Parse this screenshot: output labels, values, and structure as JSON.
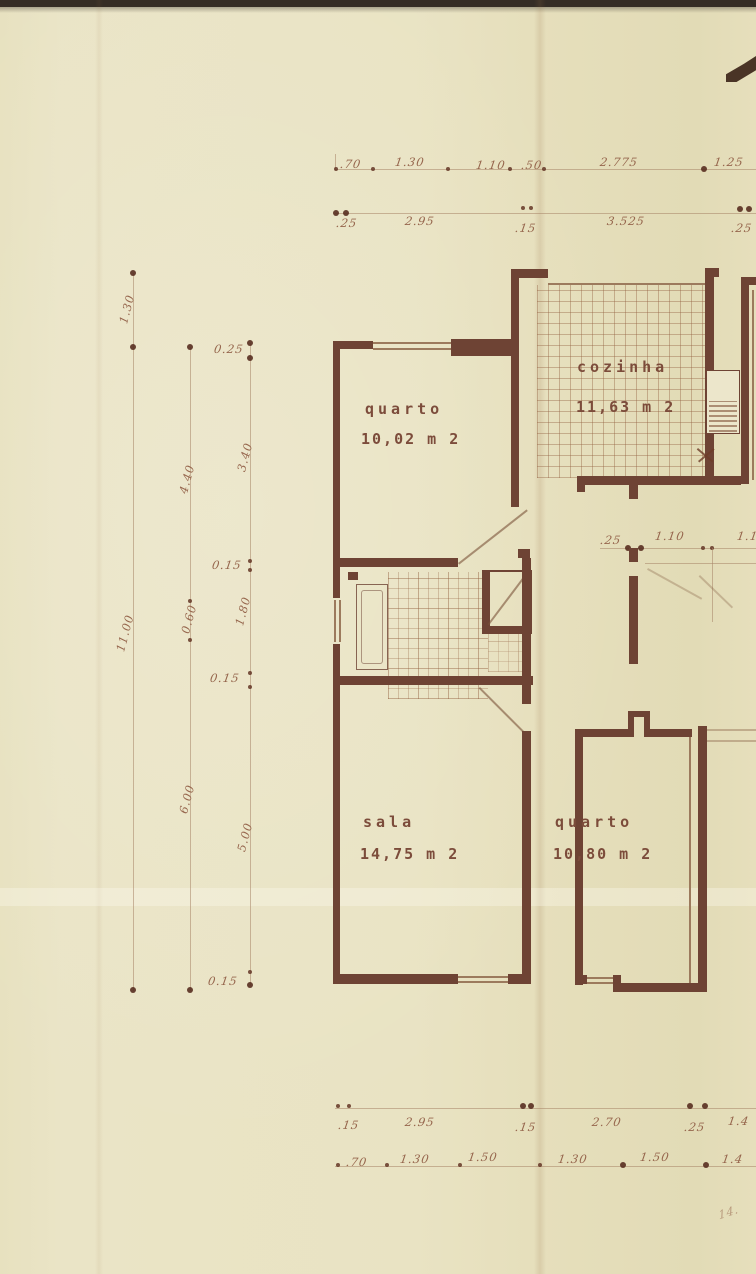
{
  "document": {
    "type": "scanned architectural floor plan"
  },
  "rooms": {
    "quarto1": {
      "name": "quarto",
      "area": "10,02 m 2"
    },
    "cozinha": {
      "name": "cozinha",
      "area": "11,63 m 2"
    },
    "sala": {
      "name": "sala",
      "area": "14,75 m 2"
    },
    "quarto2": {
      "name": "quarto",
      "area": "10,80 m 2"
    }
  },
  "dimensions": {
    "top_upper": [
      ".70",
      "1.30",
      "1.10",
      ".50",
      "2.775",
      "1.25"
    ],
    "top_lower": [
      ".25",
      "2.95",
      ".15",
      "3.525",
      ".25"
    ],
    "middle": [
      ".25",
      "1.10",
      "1.1"
    ],
    "left_outer": [
      "1.30",
      "11.00"
    ],
    "left_middle": [
      "4.40",
      "0.60",
      "6.00"
    ],
    "left_inner": [
      "0.25",
      "3.40",
      "0.15",
      "1.80",
      "0.15",
      "5.00",
      "0.15"
    ],
    "bottom_upper": [
      ".15",
      "2.95",
      ".15",
      "2.70",
      ".25",
      "1.4"
    ],
    "bottom_lower": [
      ".70",
      "1.30",
      "1.50",
      "1.30",
      "1.50",
      "1.4"
    ],
    "corner_note": "14."
  },
  "colors": {
    "paper": "#e9e3c3",
    "ink_wall": "#6e4334",
    "ink_dim": "#96664d",
    "scan_bar": "#352c25"
  }
}
